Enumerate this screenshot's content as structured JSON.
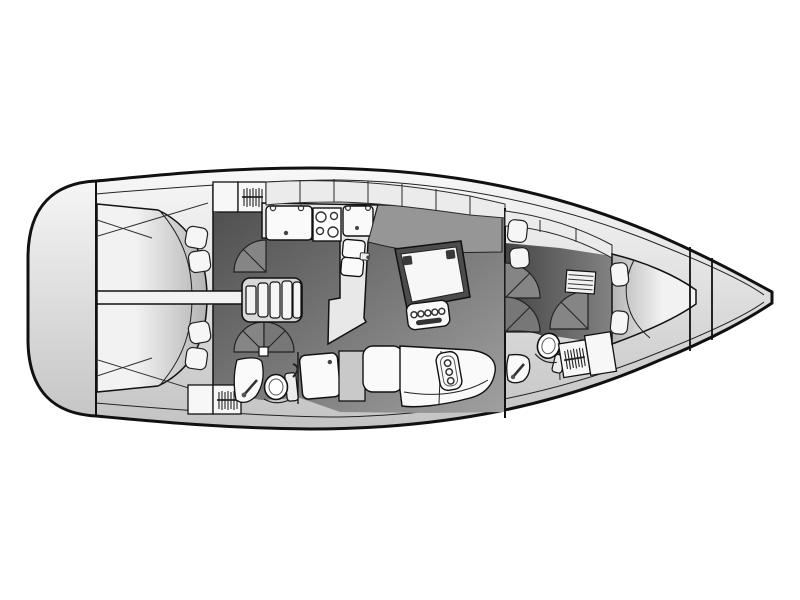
{
  "diagram": {
    "type": "yacht-floor-plan",
    "title": "Sailing yacht interior layout, top view (bow to the right)",
    "orientation": {
      "bow": "right",
      "stern": "left"
    },
    "rooms": [
      {
        "id": "transom",
        "label": "transom-swim-platform"
      },
      {
        "id": "aft-cabin-port",
        "label": "aft-double-cabin-port",
        "furniture": [
          "double-berth",
          "pillow",
          "pillow",
          "shelf-locker",
          "hanging-locker",
          "door-swing"
        ]
      },
      {
        "id": "aft-cabin-starboard",
        "label": "aft-double-cabin-starboard",
        "furniture": [
          "double-berth",
          "pillow",
          "pillow",
          "shelf-locker",
          "hanging-locker",
          "pivot-door"
        ]
      },
      {
        "id": "aft-head",
        "label": "aft-head-wc",
        "furniture": [
          "sink",
          "toilet",
          "shower-tray"
        ]
      },
      {
        "id": "companionway",
        "label": "companionway-steps"
      },
      {
        "id": "galley",
        "label": "l-shaped-galley",
        "furniture": [
          "sink-unit",
          "stove-4-burner",
          "counter",
          "fridge-two-door"
        ]
      },
      {
        "id": "salon",
        "label": "salon",
        "furniture": [
          "dining-table",
          "bottle-rack",
          "port-settee-back",
          "corner-seat",
          "starboard-settee",
          "seat-insert"
        ]
      },
      {
        "id": "forward-head",
        "label": "forward-head-wc",
        "furniture": [
          "toilet",
          "sink",
          "door-swing"
        ]
      },
      {
        "id": "forward-cabin",
        "label": "forward-cabin",
        "furniture": [
          "v-berth",
          "pillow",
          "pillow",
          "drawer-unit",
          "hanging-locker",
          "shelf-locker",
          "door-swing"
        ]
      },
      {
        "id": "anchor-locker",
        "label": "anchor-locker-bow"
      }
    ],
    "icons": [
      "clothes-hanger-icon",
      "stove-burners-icon",
      "faucet-icon",
      "drain-dot-icon"
    ],
    "colors": {
      "background": "#ffffff",
      "outline": "#111111",
      "hullLight": "#f8f8f8",
      "hullDark": "#c3c3c3",
      "deckBand": "#ebebeb",
      "cabinet": "#e8e8e8",
      "berthLight": "#f2f2f2",
      "berthDark": "#b4b4b4",
      "floorDark": "#4e4e4e",
      "floorLight": "#a0a0a0",
      "fwdFloorDark": "#454545",
      "fwdFloorLight": "#828282",
      "furniture": "#fafafa",
      "seatGray": "#c9c9c9",
      "backrest": "#969696",
      "tableRim": "#4c4c4c",
      "tableTop": "#f7f7f7",
      "doorFan": "#858585",
      "stairsBase": "#d8d8d8",
      "barFill": "#f2f2f2",
      "detailDark": "#333333"
    }
  }
}
